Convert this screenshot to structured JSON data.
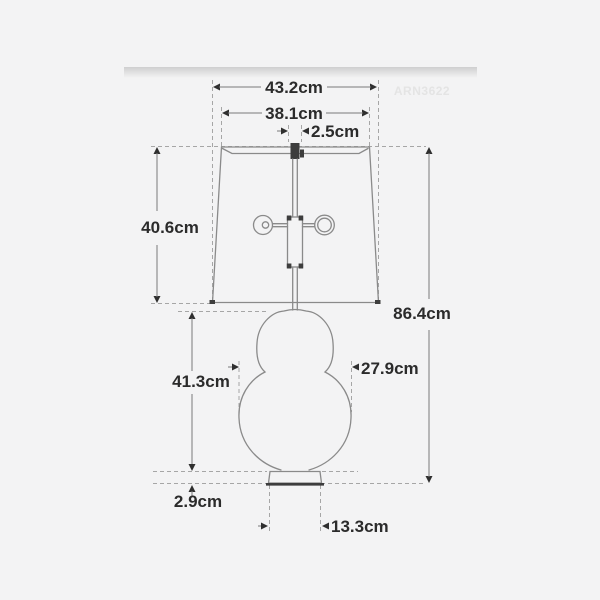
{
  "image": {
    "watermark": "ARN3622",
    "type_note": "table lamp dimension diagram"
  },
  "dimensions": {
    "shade_bottom_width": "43.2cm",
    "shade_top_width": "38.1cm",
    "finial_width": "2.5cm",
    "shade_height": "40.6cm",
    "overall_height": "86.4cm",
    "base_height": "41.3cm",
    "base_width": "27.9cm",
    "foot_height": "2.9cm",
    "foot_width": "13.3cm"
  },
  "colors": {
    "background": "#f3f3f4",
    "drawing_line": "#8a8a8a",
    "dashed_line": "#a6a6a6",
    "dimension_text": "#2b2b2b",
    "arrow": "#2f2f2f",
    "dark_accent": "#3d3d3d",
    "watermark": "#e4e4e4"
  }
}
